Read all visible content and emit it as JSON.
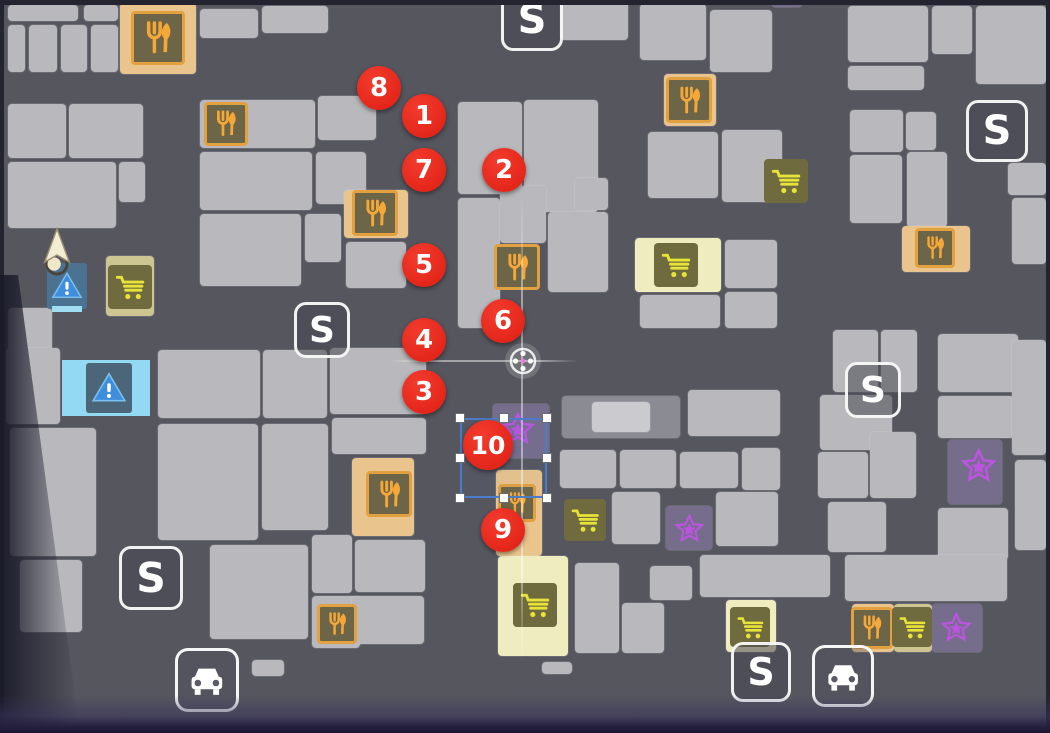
{
  "map": {
    "title": "city-minimap",
    "colors": {
      "street": "#56565f",
      "building": "#b9b9bd",
      "marker_red": "#e0structured1d12",
      "food_glyph": "#f5a838",
      "cart_glyph": "#e8e338",
      "star_glyph": "#bb55e0",
      "white": "#ffffff",
      "warning_blue": "#3f8edc",
      "warning_bg_light": "#93d9f3",
      "player_cream": "#f2ecd2",
      "target_pink": "#ef7ae0",
      "selection_blue": "#4a7cc9",
      "border_dark": "#23242f",
      "bottom_band": "#201c38"
    },
    "s_label": "S",
    "buildings": [
      [
        8,
        5,
        70,
        16
      ],
      [
        84,
        5,
        34,
        16
      ],
      [
        8,
        25,
        17,
        47
      ],
      [
        29,
        25,
        28,
        47
      ],
      [
        61,
        25,
        26,
        47
      ],
      [
        91,
        25,
        27,
        47
      ],
      [
        120,
        3,
        76,
        71,
        3
      ],
      [
        200,
        9,
        58,
        29
      ],
      [
        262,
        6,
        66,
        27
      ],
      [
        8,
        104,
        58,
        54
      ],
      [
        69,
        104,
        74,
        54
      ],
      [
        8,
        162,
        108,
        66
      ],
      [
        119,
        162,
        26,
        40
      ],
      [
        8,
        308,
        44,
        46
      ],
      [
        200,
        100,
        115,
        48
      ],
      [
        318,
        96,
        58,
        44
      ],
      [
        200,
        152,
        112,
        58
      ],
      [
        316,
        152,
        50,
        52
      ],
      [
        344,
        190,
        64,
        48,
        3
      ],
      [
        200,
        214,
        101,
        72
      ],
      [
        305,
        214,
        36,
        48
      ],
      [
        346,
        242,
        60,
        46
      ],
      [
        458,
        102,
        64,
        92
      ],
      [
        524,
        100,
        74,
        112
      ],
      [
        458,
        198,
        42,
        130
      ],
      [
        500,
        186,
        46,
        57
      ],
      [
        548,
        212,
        60,
        80
      ],
      [
        575,
        178,
        33,
        32
      ],
      [
        560,
        0,
        68,
        40
      ],
      [
        640,
        4,
        66,
        56
      ],
      [
        710,
        10,
        62,
        62
      ],
      [
        664,
        74,
        52,
        52,
        3
      ],
      [
        648,
        132,
        70,
        66
      ],
      [
        722,
        130,
        60,
        72
      ],
      [
        772,
        0,
        30,
        7,
        6
      ],
      [
        848,
        6,
        80,
        56
      ],
      [
        932,
        6,
        40,
        48
      ],
      [
        976,
        6,
        70,
        78
      ],
      [
        848,
        66,
        76,
        24
      ],
      [
        850,
        110,
        53,
        42
      ],
      [
        906,
        112,
        30,
        38
      ],
      [
        850,
        155,
        52,
        68
      ],
      [
        907,
        152,
        40,
        75
      ],
      [
        902,
        226,
        68,
        46,
        3
      ],
      [
        1008,
        163,
        38,
        32
      ],
      [
        1012,
        198,
        34,
        66
      ],
      [
        635,
        238,
        86,
        54,
        4
      ],
      [
        725,
        240,
        52,
        48
      ],
      [
        640,
        295,
        80,
        33
      ],
      [
        725,
        292,
        52,
        36
      ],
      [
        833,
        330,
        45,
        62
      ],
      [
        881,
        330,
        36,
        62
      ],
      [
        820,
        395,
        72,
        55
      ],
      [
        818,
        452,
        50,
        46
      ],
      [
        870,
        432,
        46,
        66
      ],
      [
        828,
        502,
        58,
        50
      ],
      [
        938,
        334,
        80,
        58
      ],
      [
        938,
        396,
        76,
        42
      ],
      [
        948,
        440,
        54,
        64,
        6
      ],
      [
        938,
        508,
        70,
        52
      ],
      [
        1012,
        340,
        34,
        115
      ],
      [
        1015,
        460,
        31,
        90
      ],
      [
        845,
        555,
        162,
        46
      ],
      [
        700,
        555,
        130,
        42
      ],
      [
        726,
        600,
        50,
        52,
        4
      ],
      [
        852,
        604,
        42,
        48,
        3
      ],
      [
        894,
        604,
        38,
        48,
        7
      ],
      [
        932,
        604,
        50,
        48,
        6
      ],
      [
        493,
        404,
        56,
        54,
        6
      ],
      [
        562,
        396,
        118,
        42,
        5
      ],
      [
        592,
        402,
        58,
        30,
        2
      ],
      [
        688,
        390,
        92,
        46
      ],
      [
        560,
        450,
        56,
        38
      ],
      [
        620,
        450,
        56,
        38
      ],
      [
        680,
        452,
        58,
        36
      ],
      [
        742,
        448,
        38,
        42
      ],
      [
        496,
        470,
        46,
        86,
        3
      ],
      [
        612,
        492,
        48,
        52
      ],
      [
        666,
        506,
        46,
        44,
        6
      ],
      [
        716,
        492,
        62,
        54
      ],
      [
        498,
        556,
        70,
        100,
        4
      ],
      [
        575,
        563,
        44,
        90
      ],
      [
        622,
        603,
        42,
        50
      ],
      [
        650,
        566,
        42,
        34
      ],
      [
        158,
        350,
        102,
        68
      ],
      [
        263,
        350,
        64,
        68
      ],
      [
        330,
        348,
        96,
        66
      ],
      [
        158,
        424,
        100,
        116
      ],
      [
        262,
        424,
        66,
        106
      ],
      [
        352,
        458,
        62,
        78,
        3
      ],
      [
        332,
        418,
        94,
        36
      ],
      [
        210,
        545,
        98,
        94
      ],
      [
        312,
        535,
        40,
        58
      ],
      [
        312,
        596,
        48,
        52
      ],
      [
        355,
        540,
        70,
        52
      ],
      [
        352,
        596,
        72,
        48
      ],
      [
        6,
        348,
        54,
        76
      ],
      [
        10,
        428,
        86,
        128
      ],
      [
        20,
        560,
        62,
        72
      ],
      [
        106,
        256,
        48,
        60,
        7
      ],
      [
        252,
        660,
        32,
        16
      ],
      [
        542,
        662,
        30,
        12
      ]
    ],
    "markers": [
      {
        "label": "1",
        "x": 424,
        "y": 116,
        "r": 22
      },
      {
        "label": "2",
        "x": 504,
        "y": 170,
        "r": 22
      },
      {
        "label": "3",
        "x": 424,
        "y": 392,
        "r": 22
      },
      {
        "label": "4",
        "x": 424,
        "y": 340,
        "r": 22
      },
      {
        "label": "5",
        "x": 424,
        "y": 265,
        "r": 22
      },
      {
        "label": "6",
        "x": 503,
        "y": 321,
        "r": 22
      },
      {
        "label": "7",
        "x": 424,
        "y": 170,
        "r": 22
      },
      {
        "label": "8",
        "x": 379,
        "y": 88,
        "r": 22
      },
      {
        "label": "9",
        "x": 503,
        "y": 530,
        "r": 22
      },
      {
        "label": "10",
        "x": 488,
        "y": 445,
        "r": 25
      }
    ],
    "save_points": [
      {
        "x": 532,
        "y": 20,
        "s": 62
      },
      {
        "x": 322,
        "y": 330,
        "s": 56
      },
      {
        "x": 997,
        "y": 131,
        "s": 62
      },
      {
        "x": 873,
        "y": 390,
        "s": 56
      },
      {
        "x": 151,
        "y": 578,
        "s": 64
      },
      {
        "x": 761,
        "y": 672,
        "s": 60
      }
    ],
    "taxi_stands": [
      {
        "x": 207,
        "y": 680,
        "s": 64
      },
      {
        "x": 843,
        "y": 676,
        "s": 62
      }
    ],
    "restaurants": [
      {
        "x": 158,
        "y": 38,
        "s": 54
      },
      {
        "x": 226,
        "y": 124,
        "s": 44
      },
      {
        "x": 375,
        "y": 213,
        "s": 46
      },
      {
        "x": 689,
        "y": 100,
        "s": 46
      },
      {
        "x": 517,
        "y": 267,
        "s": 46
      },
      {
        "x": 935,
        "y": 248,
        "s": 40
      },
      {
        "x": 389,
        "y": 494,
        "s": 46
      },
      {
        "x": 337,
        "y": 624,
        "s": 40
      },
      {
        "x": 517,
        "y": 503,
        "s": 38
      },
      {
        "x": 872,
        "y": 628,
        "s": 42
      }
    ],
    "shops": [
      {
        "x": 130,
        "y": 287,
        "s": 44
      },
      {
        "x": 786,
        "y": 181,
        "s": 44
      },
      {
        "x": 676,
        "y": 265,
        "s": 44
      },
      {
        "x": 585,
        "y": 520,
        "s": 42
      },
      {
        "x": 535,
        "y": 605,
        "s": 44
      },
      {
        "x": 750,
        "y": 627,
        "s": 40
      },
      {
        "x": 912,
        "y": 627,
        "s": 40
      }
    ],
    "stars": [
      {
        "x": 518,
        "y": 430,
        "s": 46
      },
      {
        "x": 689,
        "y": 529,
        "s": 40
      },
      {
        "x": 979,
        "y": 467,
        "s": 48
      },
      {
        "x": 956,
        "y": 628,
        "s": 42
      }
    ],
    "warnings": {
      "small": {
        "x": 67,
        "y": 286
      },
      "large": {
        "x": 106,
        "y": 388
      }
    },
    "player": {
      "x": 57,
      "y": 252
    },
    "target": {
      "x": 523,
      "y": 361
    },
    "crosshair": {
      "v": {
        "x": 522,
        "y1": 198,
        "y2": 662
      },
      "h": {
        "y": 361,
        "x1": 388,
        "x2": 578
      }
    },
    "selection": {
      "x": 460,
      "y": 418,
      "w": 87,
      "h": 80
    }
  }
}
